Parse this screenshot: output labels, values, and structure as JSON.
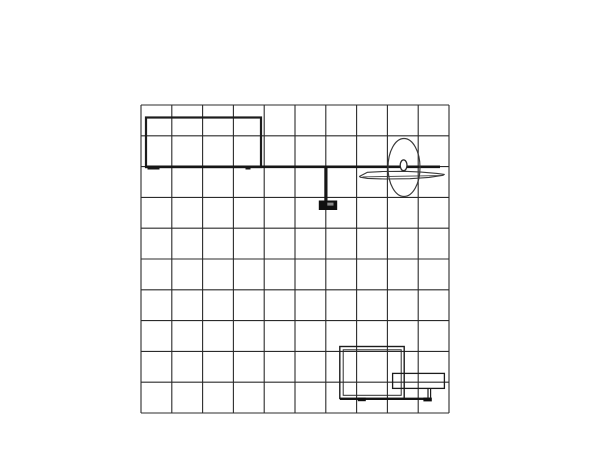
{
  "page": {
    "background_color": "#ffffff",
    "visible_text": []
  },
  "drawing": {
    "canvas": {
      "width": 600,
      "height": 463,
      "background": "#ffffff"
    },
    "colors": {
      "grid_line": "#2b2b2b",
      "outline": "#3a3a3a",
      "heavy_line": "#161616",
      "solid_fill": "#101010",
      "detail_gray": "#8a8a8a",
      "white": "#ffffff"
    },
    "elements": [
      {
        "name": "grid-wall",
        "type": "grid",
        "x": 141,
        "y": 105,
        "width": 308,
        "height": 308,
        "cols": 10,
        "rows": 10,
        "stroke": "#2b2b2b",
        "stroke_width": 1.1
      },
      {
        "name": "header-panel",
        "type": "rect",
        "x": 146,
        "y": 117.5,
        "width": 115,
        "height": 49.5,
        "stroke": "#1c1c1c",
        "stroke_width": 2.2,
        "fill": "none"
      },
      {
        "name": "shelf-rail",
        "type": "line",
        "x1": 145,
        "y1": 166.8,
        "x2": 440,
        "y2": 166.8,
        "stroke": "#161616",
        "stroke_width": 2.6
      },
      {
        "name": "rail-foot-left",
        "type": "rect",
        "x": 147.5,
        "y": 167.9,
        "width": 12,
        "height": 1.6,
        "fill": "#161616"
      },
      {
        "name": "rail-foot-mid",
        "type": "rect",
        "x": 245.5,
        "y": 167.9,
        "width": 5,
        "height": 1.6,
        "fill": "#161616"
      },
      {
        "name": "monitor-pole",
        "type": "rect",
        "x": 324.3,
        "y": 167,
        "width": 3.2,
        "height": 34,
        "fill": "#161616"
      },
      {
        "name": "monitor-body",
        "type": "rect",
        "x": 318.8,
        "y": 200.5,
        "width": 18.4,
        "height": 9.5,
        "fill": "#101010"
      },
      {
        "name": "monitor-screen-detail",
        "type": "rect",
        "x": 327.3,
        "y": 202.6,
        "width": 6.2,
        "height": 3,
        "fill": "#8a8a8a"
      },
      {
        "name": "display-oval",
        "type": "ellipse",
        "cx": 404,
        "cy": 167.5,
        "rx": 16,
        "ry": 29,
        "stroke": "#3a3a3a",
        "stroke_width": 1.2,
        "fill": "none"
      },
      {
        "name": "surfboard-shelf-outline",
        "type": "polygon",
        "points": "359.5,176.4 367.5,172.3 383,171.5 405,171.3 421,172.1 437,173.4 444.3,174.4 443,175.3 429,177.4 410,178.7 385,179 367.5,178.4 360.3,177.2",
        "stroke": "#3a3a3a",
        "stroke_width": 1.1,
        "fill": "none"
      },
      {
        "name": "surfboard-shelf-inner-line",
        "type": "line",
        "x1": 362.5,
        "y1": 176.9,
        "x2": 441.5,
        "y2": 175.6,
        "stroke": "#3a3a3a",
        "stroke_width": 0.9
      },
      {
        "name": "rail-knob",
        "type": "ellipse",
        "cx": 403.6,
        "cy": 165.3,
        "rx": 3.4,
        "ry": 5.4,
        "stroke": "#2a2a2a",
        "stroke_width": 1.3,
        "fill": "#ffffff"
      },
      {
        "name": "counter-outer",
        "type": "rect",
        "x": 339.8,
        "y": 346.5,
        "width": 64.4,
        "height": 52,
        "stroke": "#1c1c1c",
        "stroke_width": 1.4,
        "fill": "none"
      },
      {
        "name": "counter-inner",
        "type": "rect",
        "x": 343.2,
        "y": 349.8,
        "width": 58,
        "height": 45.5,
        "stroke": "#2b2b2b",
        "stroke_width": 1,
        "fill": "none"
      },
      {
        "name": "base-rail",
        "type": "line",
        "x1": 340,
        "y1": 398.8,
        "x2": 430.5,
        "y2": 398.8,
        "stroke": "#161616",
        "stroke_width": 2.4
      },
      {
        "name": "base-foot-left",
        "type": "rect",
        "x": 357.8,
        "y": 397.6,
        "width": 8,
        "height": 3.6,
        "fill": "#0e0e0e"
      },
      {
        "name": "base-foot-right",
        "type": "rect",
        "x": 423.4,
        "y": 397.6,
        "width": 8.4,
        "height": 3.8,
        "fill": "#0e0e0e"
      },
      {
        "name": "counter-shelf",
        "type": "rect",
        "x": 392.6,
        "y": 373.4,
        "width": 51.8,
        "height": 15,
        "stroke": "#1c1c1c",
        "stroke_width": 1.3,
        "fill": "none"
      },
      {
        "name": "counter-shelf-leg-left",
        "type": "line",
        "x1": 428,
        "y1": 388.4,
        "x2": 428,
        "y2": 398.6,
        "stroke": "#1c1c1c",
        "stroke_width": 1.2
      },
      {
        "name": "counter-shelf-leg-right",
        "type": "line",
        "x1": 430.6,
        "y1": 388.4,
        "x2": 430.6,
        "y2": 398.6,
        "stroke": "#1c1c1c",
        "stroke_width": 1.2
      }
    ]
  }
}
